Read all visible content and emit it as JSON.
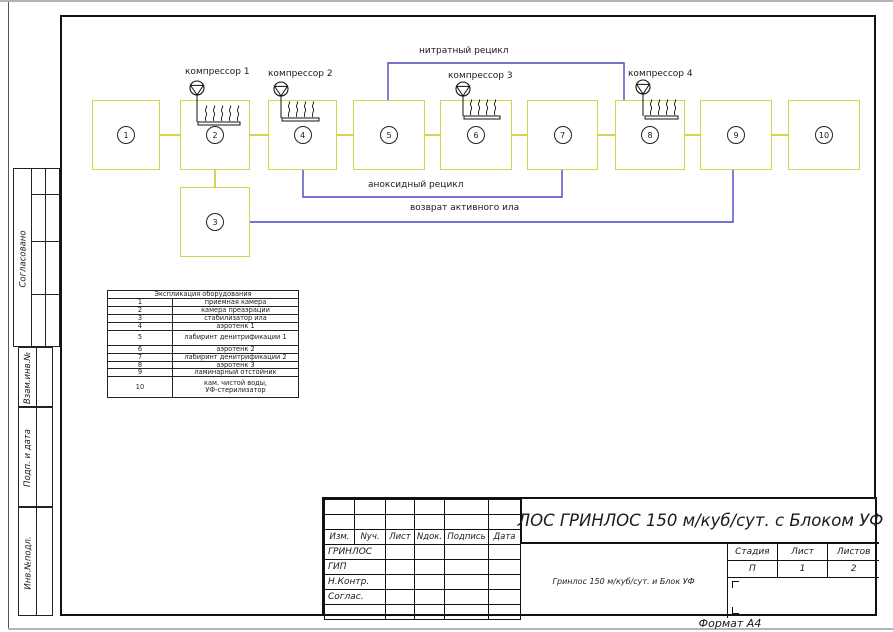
{
  "sheet": {
    "format_label": "Формат А4"
  },
  "side_strip": {
    "sections": [
      {
        "label": "Согласовано"
      },
      {
        "label": "Взам.инв.№"
      },
      {
        "label": "Подп. и дата"
      },
      {
        "label": "Инв.№подл."
      }
    ]
  },
  "diagram": {
    "boxes": [
      {
        "number": "1"
      },
      {
        "number": "2"
      },
      {
        "number": "3"
      },
      {
        "number": "4"
      },
      {
        "number": "5"
      },
      {
        "number": "6"
      },
      {
        "number": "7"
      },
      {
        "number": "8"
      },
      {
        "number": "9"
      },
      {
        "number": "10"
      }
    ],
    "compressors": [
      {
        "label": "компрессор 1"
      },
      {
        "label": "компрессор 2"
      },
      {
        "label": "компрессор 3"
      },
      {
        "label": "компрессор 4"
      }
    ],
    "flow_labels": {
      "nitrate_recycle": "нитратный рецикл",
      "anoxic_recycle": "аноксидный рецикл",
      "sludge_return": "возврат активного ила"
    },
    "colors": {
      "tank_border": "#d4d44e",
      "recycle_line": "#4747c2"
    }
  },
  "equipment_table": {
    "title": "Экспликация оборудования",
    "rows": [
      {
        "num": "1",
        "name": "приемная камера"
      },
      {
        "num": "2",
        "name": "камера преаэрации"
      },
      {
        "num": "3",
        "name": "стабилизатор ила"
      },
      {
        "num": "4",
        "name": "аэротенк 1"
      },
      {
        "num": "5",
        "name": "лабиринт денитрификации 1"
      },
      {
        "num": "6",
        "name": "аэротенк 2"
      },
      {
        "num": "7",
        "name": "лабиринт денитрификации 2"
      },
      {
        "num": "8",
        "name": "аэротенк 3"
      },
      {
        "num": "9",
        "name": "ламинарный отстойник"
      },
      {
        "num": "10",
        "name": "кам. чистой воды,",
        "name2": "УФ-стерилизатор"
      }
    ]
  },
  "title_block": {
    "main_title": "ЛОС ГРИНЛОС 150 м/куб/сут.  с Блоком УФ",
    "doc_name": "Гринлос 150 м/куб/сут. и Блок УФ",
    "header_cols": [
      "Изм.",
      "Nуч.",
      "Лист",
      "Nдок.",
      "Подпись",
      "Дата"
    ],
    "roles": [
      "ГРИНЛОС",
      "ГИП",
      "Н.Контр.",
      "Соглас."
    ],
    "stage_table": {
      "headers": [
        "Стадия",
        "Лист",
        "Листов"
      ],
      "values": [
        "П",
        "1",
        "2"
      ]
    }
  }
}
